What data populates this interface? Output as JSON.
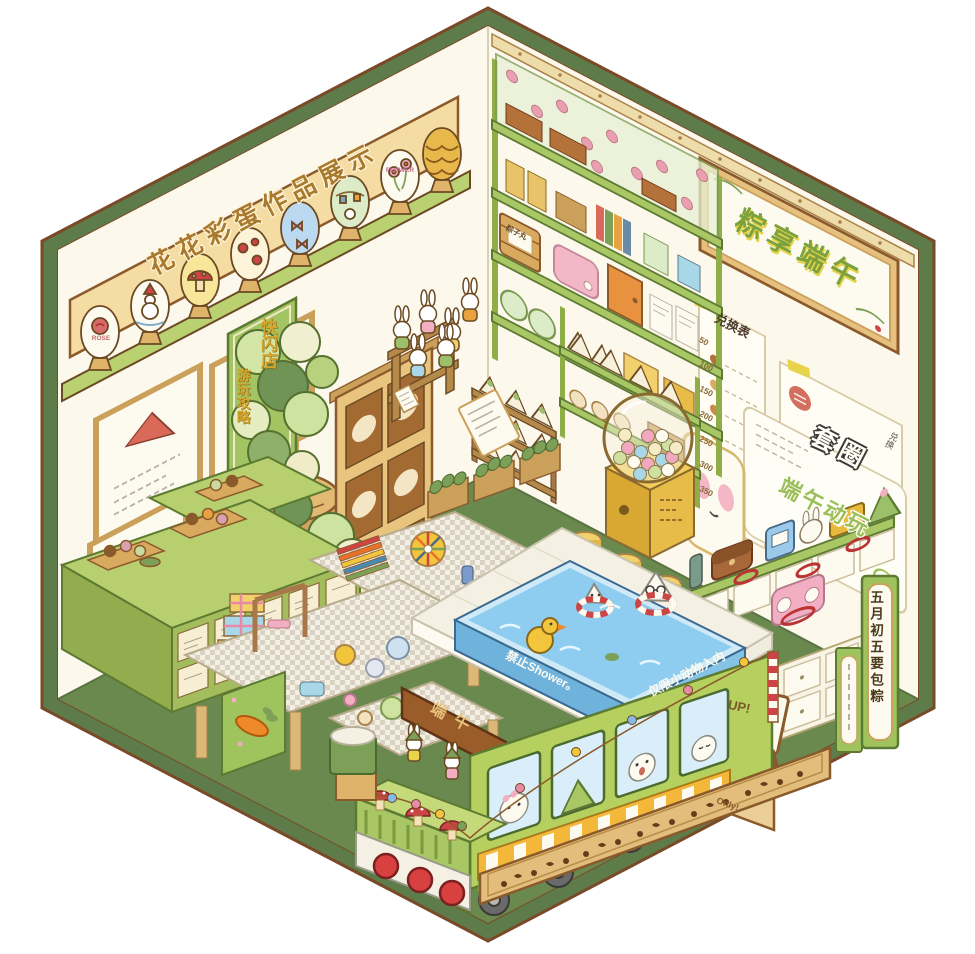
{
  "illustration": {
    "style": "isometric hexagonal diorama",
    "theme": "Dragon Boat Festival bunny pop-up shop"
  },
  "left_wall": {
    "display_banner": "花花彩蛋作品展示",
    "egg_label_rose": "ROSE",
    "egg_label_flower": "FLOWER",
    "guide_banner_title": "快闪店",
    "guide_banner_subtitle": "游玩攻略"
  },
  "right_wall": {
    "festival_sign": "粽享端午",
    "exchange_board": {
      "title": "兑换表",
      "points": [
        "50",
        "100",
        "150",
        "200",
        "250",
        "300",
        "350"
      ]
    },
    "ring_toss": {
      "title": "套圈",
      "side_note": "兑换"
    },
    "event_poster": "端午动玩"
  },
  "shop": {
    "barrel_label": "粽子丸",
    "vertical_sign": "五月初五要包粽"
  },
  "tram": {
    "roof_sign": "端午",
    "pool_rule_left": "禁止Shower。",
    "pool_rule_right": "仅限小动物入内"
  },
  "boards": {
    "up_board": "UP!",
    "carrot_board": "Only!"
  },
  "colors": {
    "frame_green": "#5e7c4a",
    "outline_brown": "#7a4a28",
    "wall_cream": "#fdf8ec",
    "floor_green": "#69894f",
    "shelf_green": "#b7cf6f",
    "wood_tan": "#e6c07f",
    "pool_blue": "#8ecdf0",
    "tram_green": "#b5d05e",
    "accent_pink": "#f2aec2",
    "accent_red": "#d94040",
    "accent_yellow": "#f2c53d"
  }
}
